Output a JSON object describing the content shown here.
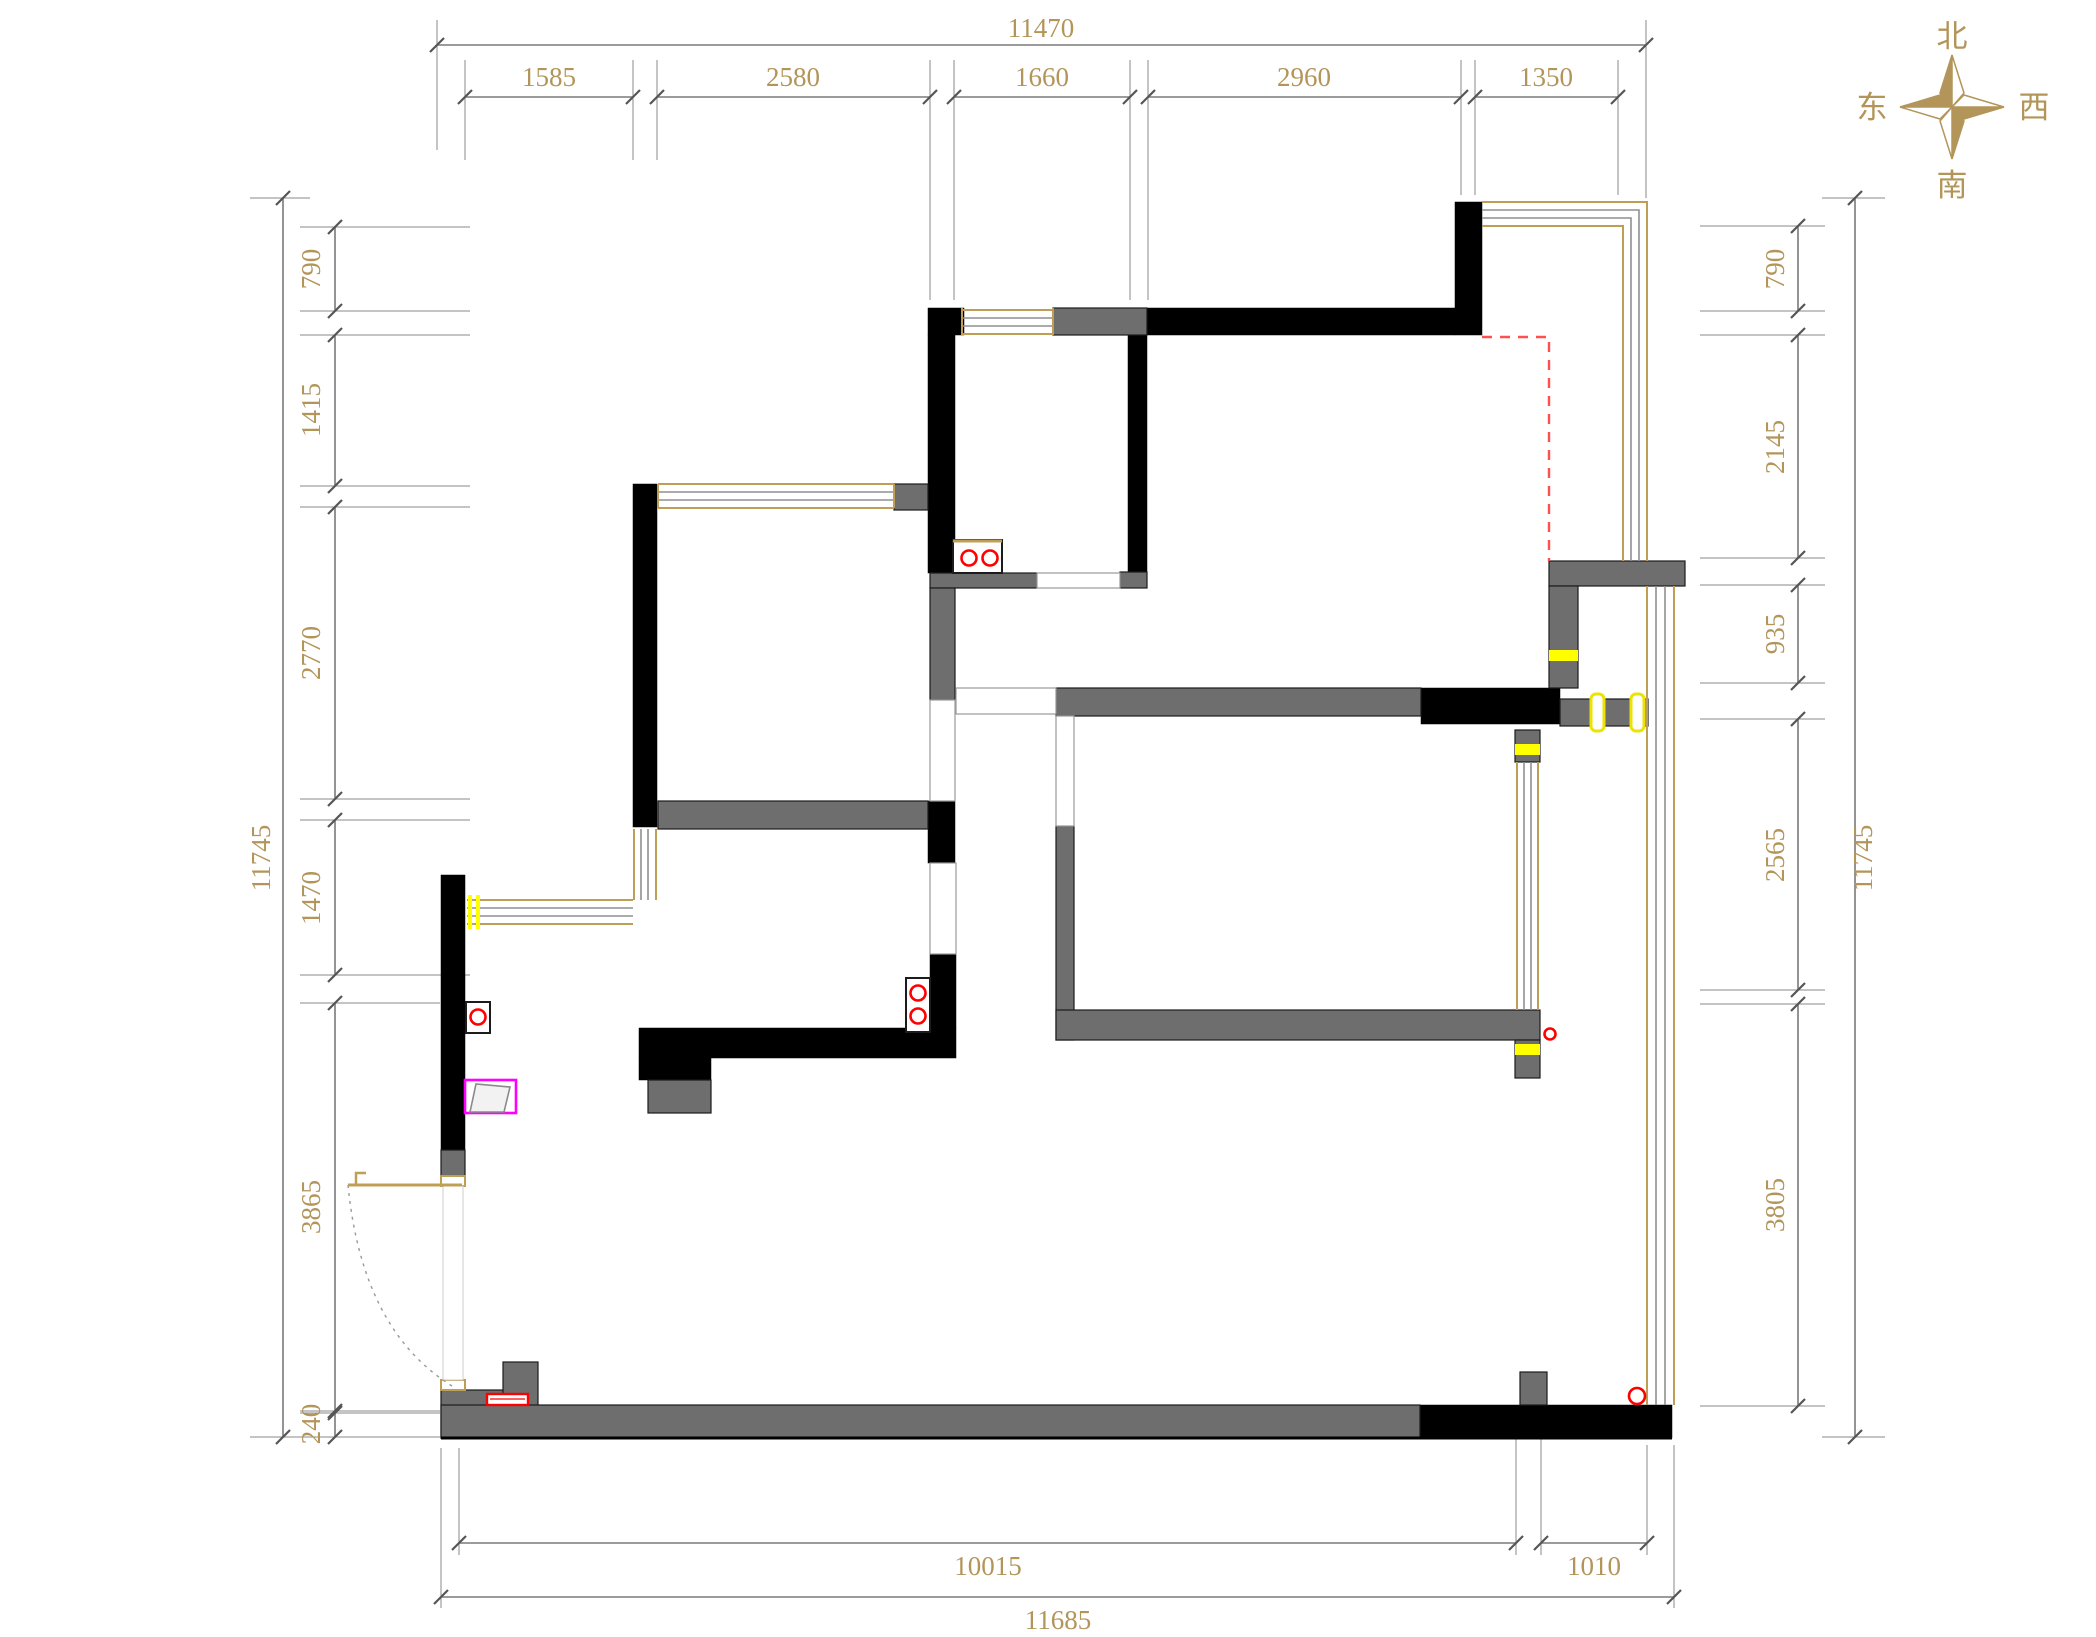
{
  "plan": {
    "title": "apartment-floor-plan",
    "compass": {
      "north": "北",
      "south": "南",
      "east": "东",
      "west": "西"
    },
    "dimensions": {
      "top_total": "11470",
      "top_segments": [
        "1585",
        "2580",
        "1660",
        "2960",
        "1350"
      ],
      "left_total": "11745",
      "left_segments": [
        "790",
        "1415",
        "2770",
        "1470",
        "3865",
        "240"
      ],
      "right_total": "11745",
      "right_segments": [
        "790",
        "2145",
        "935",
        "2565",
        "3805"
      ],
      "bottom_segments": [
        "10015",
        "1010"
      ],
      "bottom_total": "11685"
    },
    "colors": {
      "dimension_text": "#b3955a",
      "wall_black": "#000000",
      "wall_gray": "#6e6e6e",
      "window_tan": "#bf9f56",
      "highlight_yellow": "#ffff00",
      "symbol_red": "#ff0000",
      "dashed_red": "#ff5050",
      "magenta_box": "#ff00ff"
    }
  }
}
